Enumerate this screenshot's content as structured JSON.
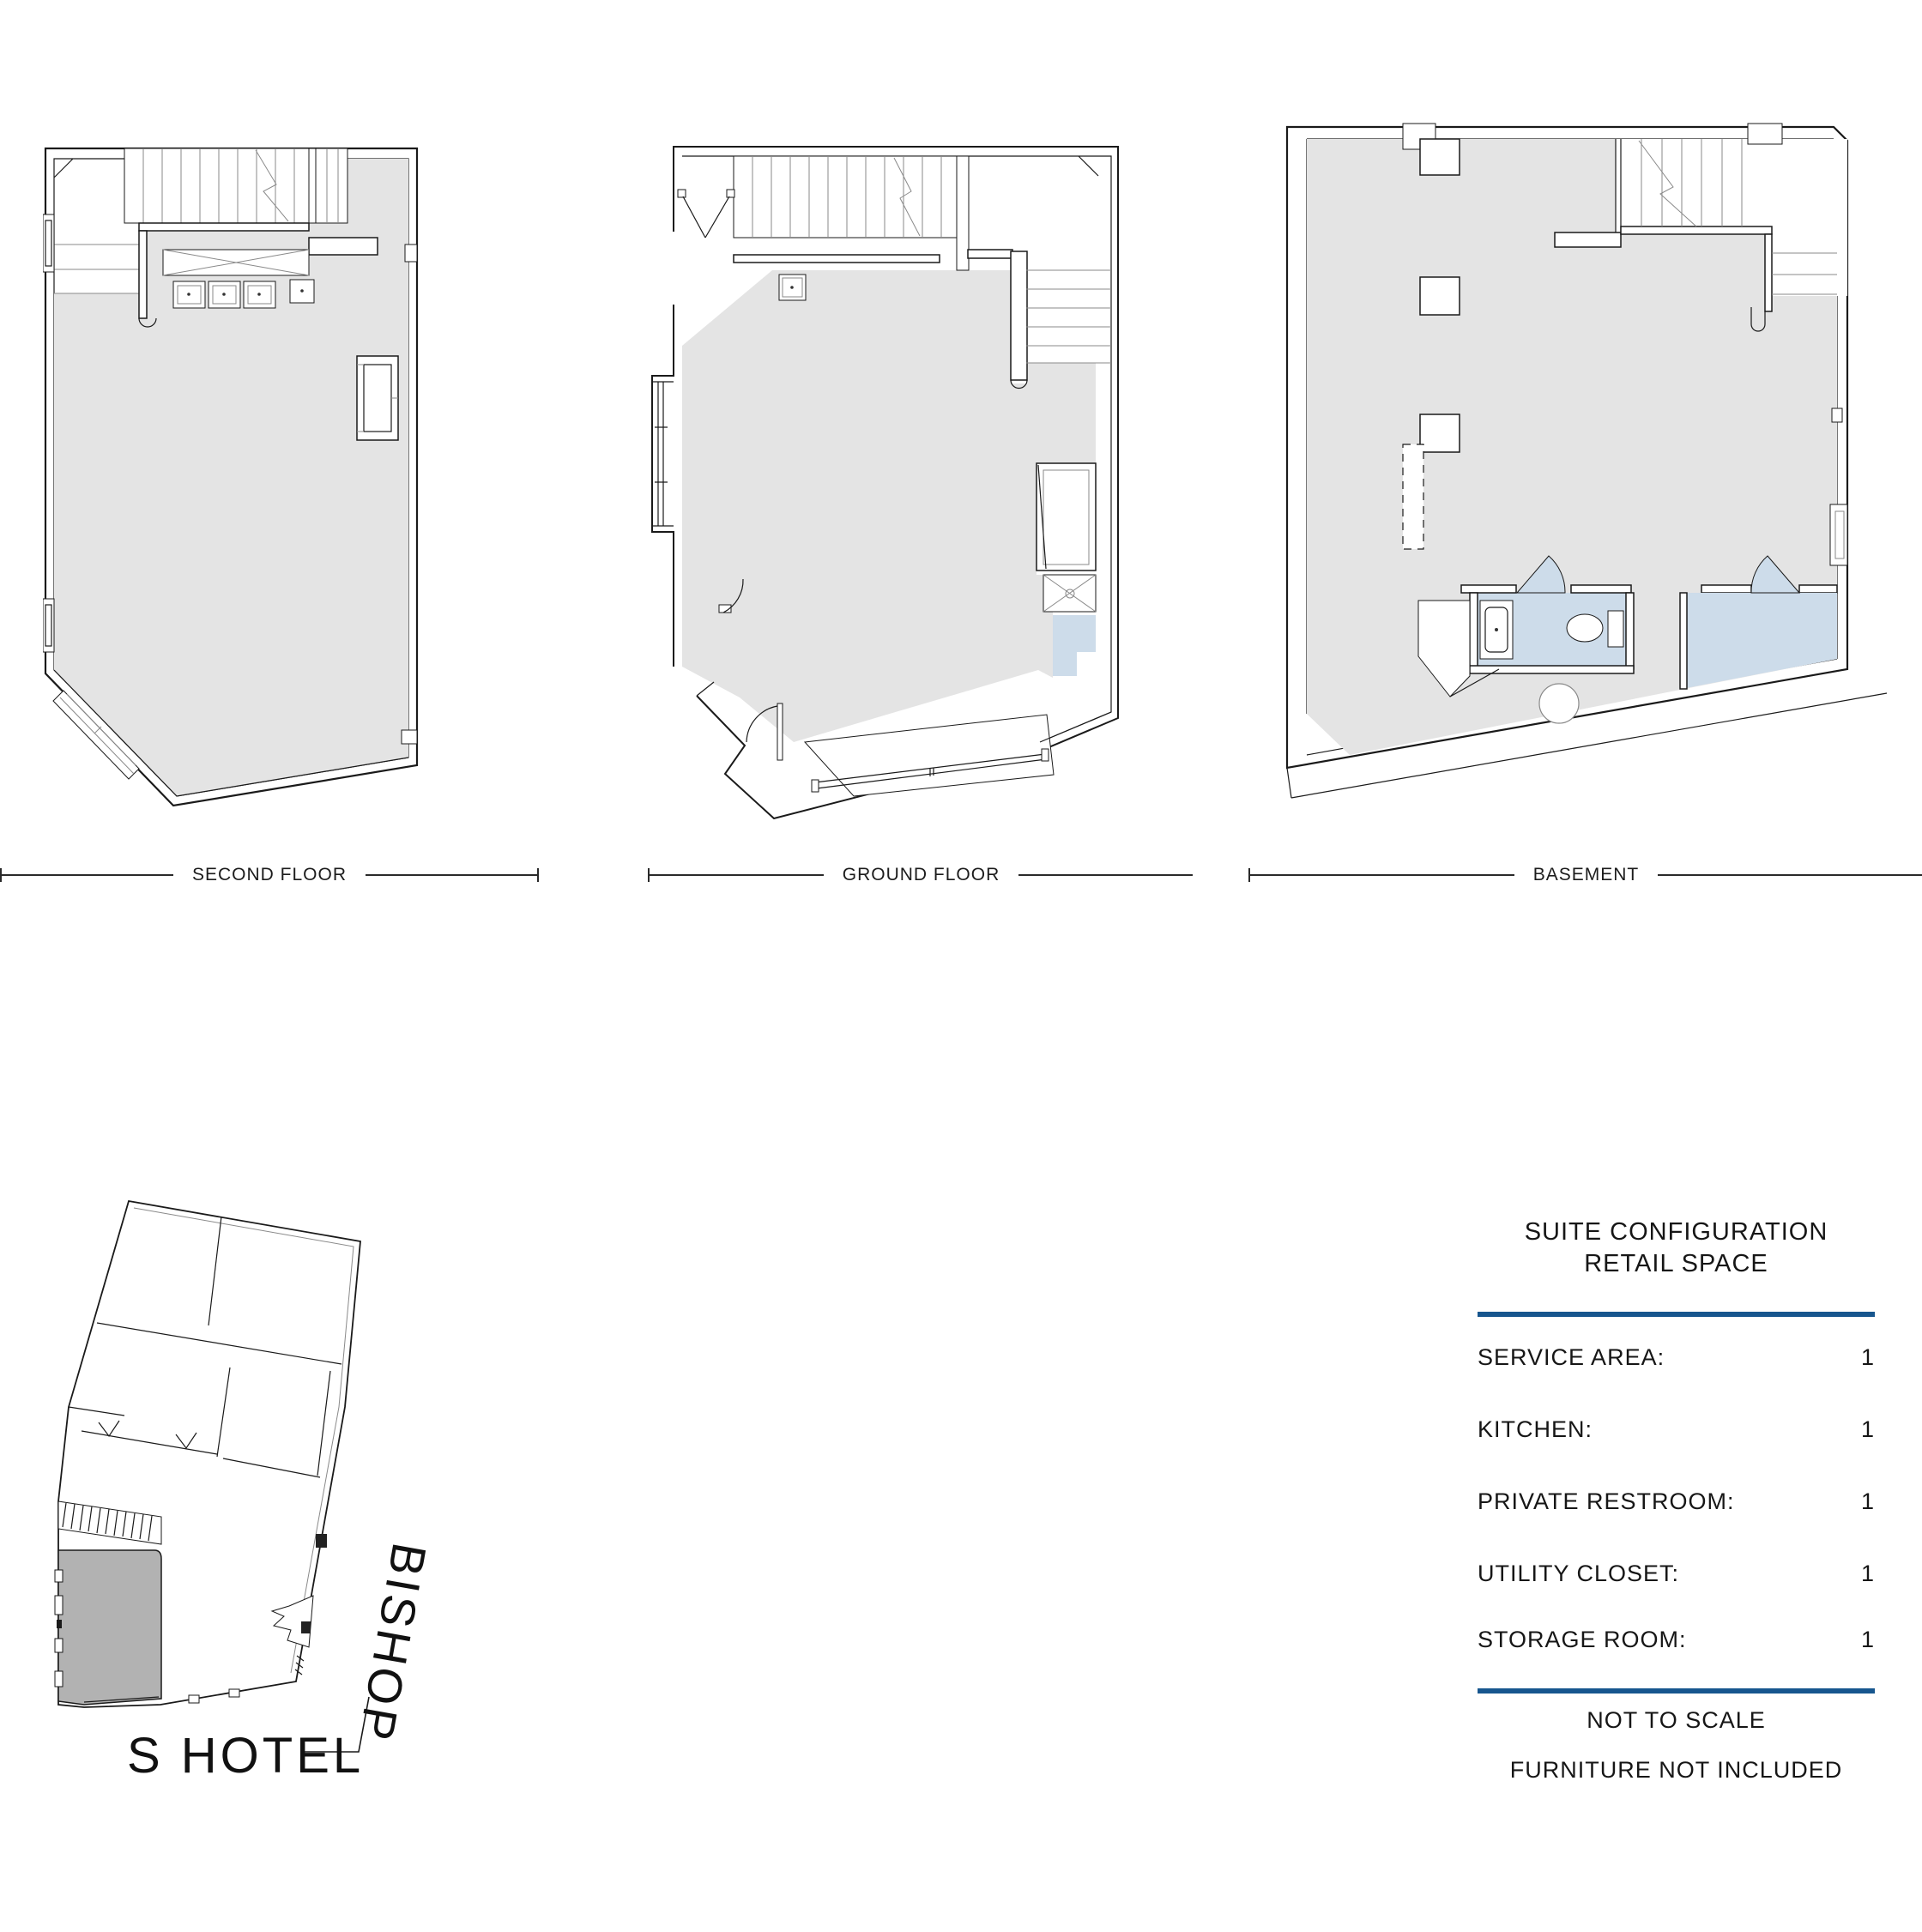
{
  "document": {
    "type": "architectural-floor-plan-sheet",
    "building": "S HOTEL",
    "street": "BISHOP"
  },
  "colors": {
    "floor_fill": "#e4e4e4",
    "highlight_room_fill": "#cddcea",
    "suite_key_fill": "#b2b2b2",
    "rule_blue": "#17568e",
    "line": "#1a1a1a"
  },
  "plans": [
    {
      "id": "second-floor",
      "label": "SECOND FLOOR"
    },
    {
      "id": "ground-floor",
      "label": "GROUND FLOOR"
    },
    {
      "id": "basement",
      "label": "BASEMENT"
    }
  ],
  "site": {
    "building_label": "S HOTEL",
    "street_label": "BISHOP"
  },
  "legend": {
    "title_line1": "SUITE CONFIGURATION",
    "title_line2": "RETAIL SPACE",
    "rows": [
      {
        "label": "SERVICE AREA:",
        "value": "1"
      },
      {
        "label": "KITCHEN:",
        "value": "1"
      },
      {
        "label": "PRIVATE RESTROOM:",
        "value": "1"
      },
      {
        "label": "UTILITY CLOSET:",
        "value": "1"
      },
      {
        "label": "STORAGE ROOM:",
        "value": "1"
      }
    ],
    "notes": [
      "NOT TO SCALE",
      "FURNITURE NOT INCLUDED"
    ]
  }
}
